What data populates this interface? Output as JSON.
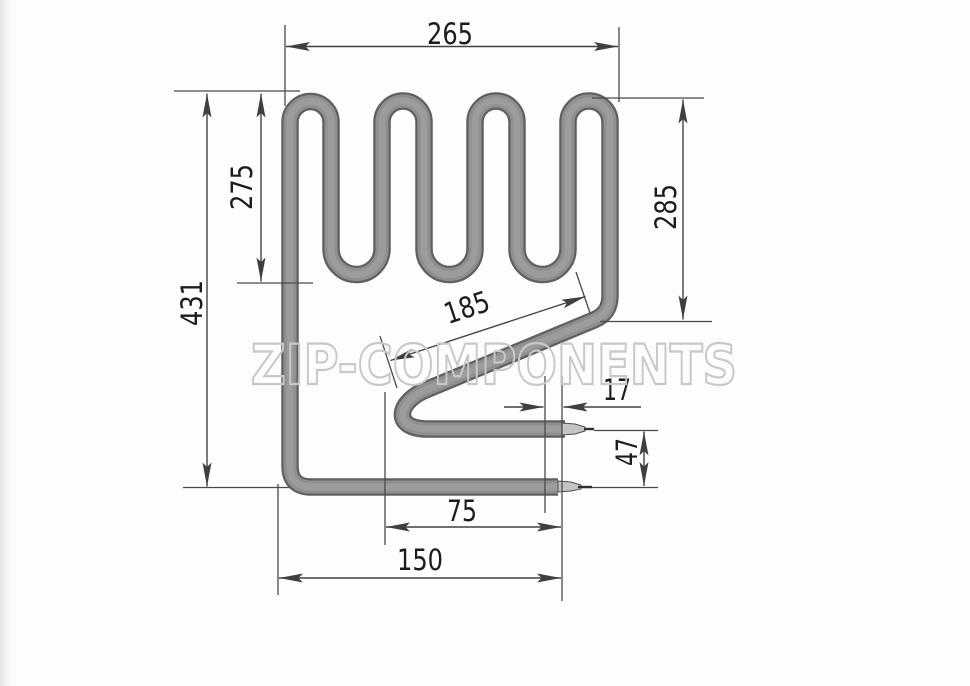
{
  "watermark": {
    "text": "ZIP-COMPONENTS"
  },
  "dimensions": {
    "top_width": "265",
    "upper_height": "275",
    "total_height": "431",
    "right_height": "285",
    "diagonal_length": "185",
    "terminal_offset": "17",
    "terminal_gap": "47",
    "inner_bottom_width": "75",
    "outer_bottom_width": "150"
  }
}
